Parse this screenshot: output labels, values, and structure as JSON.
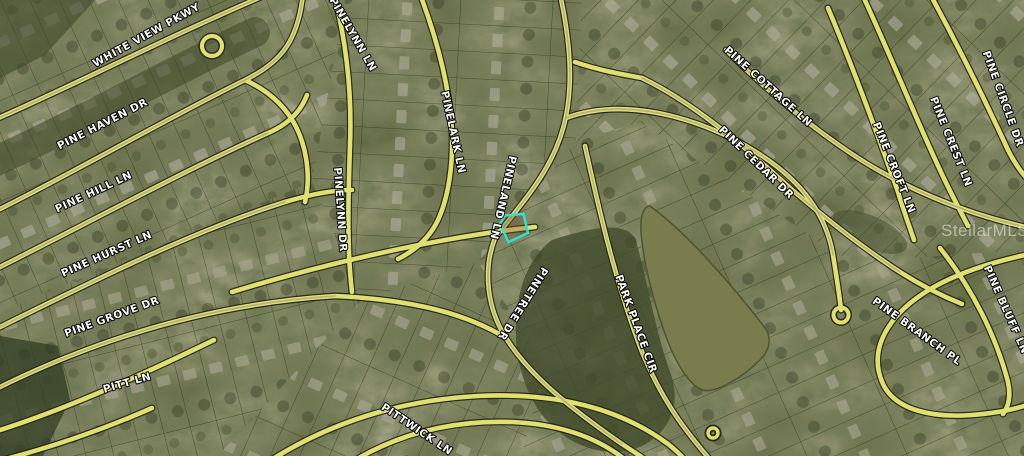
{
  "map": {
    "description": "Aerial / satellite parcel map of a residential subdivision with street name overlays, a pond, and one lot outlined in cyan",
    "watermark_text": "StellarMLS",
    "highlight": {
      "name": "subject-parcel",
      "color": "#2BE3D2"
    },
    "palette": {
      "ground": "#61673f",
      "forest": "#3c4527",
      "road": "#dfe070",
      "road_casing": "#1e1e14",
      "pond": "#7b7c4e",
      "label_fill": "#ffffff",
      "label_outline": "#000000"
    },
    "street_labels": [
      {
        "text": "WHITE VIEW PKWY",
        "x": 148,
        "y": 38,
        "rot": -29,
        "size": 12,
        "ls": 2
      },
      {
        "text": "PINE HAVEN DR",
        "x": 104,
        "y": 127,
        "rot": -27
      },
      {
        "text": "PINE HILL LN",
        "x": 95,
        "y": 195,
        "rot": -25
      },
      {
        "text": "PINE HURST LN",
        "x": 108,
        "y": 257,
        "rot": -24
      },
      {
        "text": "PINE GROVE DR",
        "x": 113,
        "y": 320,
        "rot": -20
      },
      {
        "text": "PITT LN",
        "x": 128,
        "y": 386,
        "rot": -16
      },
      {
        "text": "PITTWICK LN",
        "x": 415,
        "y": 432,
        "rot": 34,
        "ls": 1.5
      },
      {
        "text": "PINELYNN LN",
        "x": 350,
        "y": 36,
        "rot": 60
      },
      {
        "text": "PINELYNN DR",
        "x": 337,
        "y": 210,
        "rot": 86
      },
      {
        "text": "PINELARK LN",
        "x": 450,
        "y": 133,
        "rot": 78
      },
      {
        "text": "PINELAND LN",
        "x": 500,
        "y": 197,
        "rot": 103
      },
      {
        "text": "PINETREE DR",
        "x": 520,
        "y": 302,
        "rot": 122,
        "ls": 1.2
      },
      {
        "text": "PARK PLACE CIR",
        "x": 633,
        "y": 325,
        "rot": 70,
        "size": 11,
        "ls": 1.5
      },
      {
        "text": "PINE COTTAGE LN",
        "x": 766,
        "y": 89,
        "rot": 42
      },
      {
        "text": "PINE CEDAR DR",
        "x": 754,
        "y": 165,
        "rot": 44
      },
      {
        "text": "PINE CROFT LN",
        "x": 891,
        "y": 169,
        "rot": 68
      },
      {
        "text": "PINE CREST LN",
        "x": 948,
        "y": 143,
        "rot": 68
      },
      {
        "text": "PINE CIRCLE DR",
        "x": 1000,
        "y": 100,
        "rot": 70
      },
      {
        "text": "PINE BLUFF LN",
        "x": 1003,
        "y": 311,
        "rot": 66
      },
      {
        "text": "PINE BRANCH PL",
        "x": 915,
        "y": 334,
        "rot": 36
      }
    ]
  }
}
